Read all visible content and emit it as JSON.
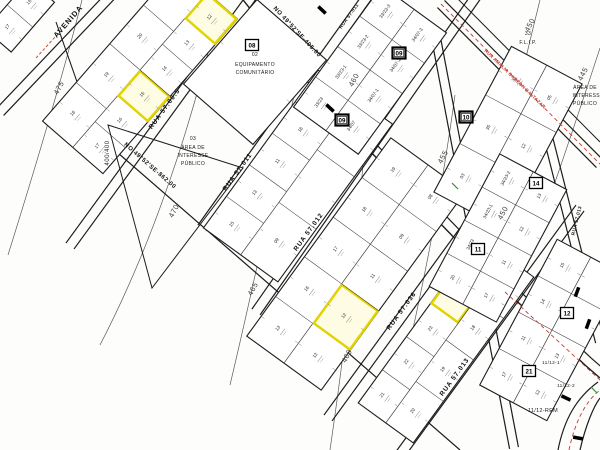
{
  "colors": {
    "background": "#fdfdfb",
    "line": "#1c1c1c",
    "lot_line": "#3c3c3c",
    "contour": "#5a5a5a",
    "highlight": "#e3d400",
    "highlight_fill": "#fffce4",
    "red": "#c43a2e",
    "green": "#3a8a3a"
  },
  "map": {
    "width": 600,
    "height": 450,
    "kind": "cadastral-subdivision-plan"
  },
  "labels": [
    {
      "t": "AVENIDA",
      "x": 70,
      "y": 23,
      "r": -49,
      "s": 7.5,
      "cls": "street"
    },
    {
      "t": "RUA 57.00.5",
      "x": 166,
      "y": 110,
      "r": -54,
      "s": 6.5,
      "cls": "street"
    },
    {
      "t": "RUA 57.011",
      "x": 239,
      "y": 173,
      "r": -54,
      "s": 6.5,
      "cls": "street"
    },
    {
      "t": "RUA 57.011",
      "x": 350,
      "y": 17,
      "r": -54,
      "s": 4.8,
      "cls": "street-sm"
    },
    {
      "t": "RUA 57.012",
      "x": 310,
      "y": 233,
      "r": -54,
      "s": 6.5,
      "cls": "street"
    },
    {
      "t": "RUA 57.036",
      "x": 403,
      "y": 312,
      "r": -54,
      "s": 6.5,
      "cls": "street"
    },
    {
      "t": "RUA 57.013",
      "x": 456,
      "y": 378,
      "r": -54,
      "s": 6.5,
      "cls": "street"
    },
    {
      "t": "RUA 57.013",
      "x": 578,
      "y": 221,
      "r": -76,
      "s": 4.8,
      "cls": "street-sm"
    },
    {
      "t": "RUA AMALIA GARZON BALTAZAR",
      "x": 514,
      "y": 80,
      "r": 44,
      "s": 4.6,
      "cls": "red"
    },
    {
      "t": "NO 49°52'SE-405.00",
      "x": 296,
      "y": 33,
      "r": 47,
      "s": 6,
      "cls": "bearing"
    },
    {
      "t": "NO 49°52'SE-862.00",
      "x": 149,
      "y": 167,
      "r": 41,
      "s": 6,
      "cls": "bearing"
    },
    {
      "t": "400/400",
      "x": 109,
      "y": 153,
      "r": -90,
      "s": 6,
      "cls": "coord"
    },
    {
      "t": "475",
      "x": 61,
      "y": 89,
      "r": -62,
      "s": 7.5,
      "cls": "contour"
    },
    {
      "t": "470",
      "x": 176,
      "y": 212,
      "r": -62,
      "s": 7.5,
      "cls": "contour"
    },
    {
      "t": "465",
      "x": 255,
      "y": 290,
      "r": -62,
      "s": 7.5,
      "cls": "contour"
    },
    {
      "t": "460",
      "x": 356,
      "y": 81,
      "r": -62,
      "s": 7.5,
      "cls": "contour"
    },
    {
      "t": "460",
      "x": 349,
      "y": 357,
      "r": -62,
      "s": 7.5,
      "cls": "contour"
    },
    {
      "t": "455",
      "x": 445,
      "y": 158,
      "r": -62,
      "s": 7.5,
      "cls": "contour"
    },
    {
      "t": "450",
      "x": 532,
      "y": 26,
      "r": -62,
      "s": 7.5,
      "cls": "contour"
    },
    {
      "t": "450",
      "x": 505,
      "y": 214,
      "r": -62,
      "s": 7.5,
      "cls": "contour"
    },
    {
      "t": "445",
      "x": 585,
      "y": 75,
      "r": -62,
      "s": 7.5,
      "cls": "contour"
    },
    {
      "t": "02",
      "x": 255,
      "y": 56,
      "r": 0,
      "s": 5,
      "cls": "area"
    },
    {
      "t": "EQUIPAMENTO",
      "x": 255,
      "y": 66,
      "r": 0,
      "s": 5,
      "cls": "area"
    },
    {
      "t": "COMUNITÁRIO",
      "x": 255,
      "y": 74,
      "r": 0,
      "s": 5,
      "cls": "area"
    },
    {
      "t": "03",
      "x": 193,
      "y": 140,
      "r": 0,
      "s": 5,
      "cls": "area"
    },
    {
      "t": "ÁREA DE",
      "x": 193,
      "y": 149,
      "r": 0,
      "s": 5,
      "cls": "area"
    },
    {
      "t": "INTERESSE",
      "x": 193,
      "y": 157,
      "r": 0,
      "s": 5,
      "cls": "area"
    },
    {
      "t": "PÚBLICO",
      "x": 193,
      "y": 165,
      "r": 0,
      "s": 5,
      "cls": "area"
    },
    {
      "t": "33",
      "x": 528,
      "y": 35,
      "r": 0,
      "s": 5,
      "cls": "area"
    },
    {
      "t": "F.L.I.P.",
      "x": 528,
      "y": 44,
      "r": 0,
      "s": 5,
      "cls": "area"
    },
    {
      "t": "ÁREA DE",
      "x": 585,
      "y": 89,
      "r": 0,
      "s": 5,
      "cls": "area"
    },
    {
      "t": "INTERESSE",
      "x": 588,
      "y": 97,
      "r": 0,
      "s": 5,
      "cls": "area"
    },
    {
      "t": "PÚBLICO",
      "x": 585,
      "y": 105,
      "r": 0,
      "s": 5,
      "cls": "area"
    },
    {
      "t": "11/12-1",
      "x": 551,
      "y": 364,
      "r": 0,
      "s": 4.8,
      "cls": "area"
    },
    {
      "t": "11/12-2",
      "x": 566,
      "y": 387,
      "r": 0,
      "s": 4.8,
      "cls": "area"
    },
    {
      "t": "11/12-REM",
      "x": 543,
      "y": 412,
      "r": 0,
      "s": 5.5,
      "cls": "area"
    }
  ],
  "block_markers": [
    {
      "n": "08",
      "x": 252,
      "y": 45,
      "heavy": false
    },
    {
      "n": "09",
      "x": 399,
      "y": 53,
      "heavy": true
    },
    {
      "n": "09",
      "x": 342,
      "y": 120,
      "heavy": true
    },
    {
      "n": "10",
      "x": 466,
      "y": 117,
      "heavy": true
    },
    {
      "n": "14",
      "x": 536,
      "y": 183,
      "heavy": false
    },
    {
      "n": "11",
      "x": 478,
      "y": 249,
      "heavy": false
    },
    {
      "n": "12",
      "x": 567,
      "y": 313,
      "heavy": false
    },
    {
      "n": "21",
      "x": 529,
      "y": 371,
      "heavy": false
    }
  ],
  "blocks": [
    {
      "cx": 20,
      "cy": 16,
      "rot": -49,
      "len": 66,
      "rows": [
        {
          "h": 34,
          "lots": [
            "17",
            "18"
          ]
        }
      ],
      "hl": []
    },
    {
      "cx": 140,
      "cy": 70,
      "rot": -49,
      "len": 205,
      "rows": [
        {
          "h": 40,
          "lots": [
            "18",
            "19",
            "20",
            ""
          ]
        },
        {
          "h": 40,
          "lots": [
            "17",
            "16",
            "15",
            "14",
            "13",
            "12"
          ]
        }
      ],
      "hl": [
        [
          1,
          2
        ],
        [
          1,
          5
        ]
      ]
    },
    {
      "cx": 255,
      "cy": 72,
      "rot": -49,
      "len": 112,
      "rows": [
        {
          "h": 92,
          "lots": [
            ""
          ]
        }
      ],
      "hl": []
    },
    {
      "cx": 298,
      "cy": 176,
      "rot": -54,
      "len": 195,
      "rows": [
        {
          "h": 46,
          "lots": [
            "15",
            "13",
            "11",
            "16",
            "10"
          ]
        },
        {
          "h": 46,
          "lots": [
            "09",
            "",
            "09"
          ]
        }
      ],
      "hl": []
    },
    {
      "cx": 370,
      "cy": 70,
      "rot": -54,
      "len": 150,
      "rows": [
        {
          "h": 40,
          "lots": [
            "33/23",
            "33/23-1",
            "33/23-2",
            "33/23-3"
          ]
        },
        {
          "h": 40,
          "lots": [
            "34/07",
            "34/07-1",
            "34/07-2",
            "34/07-3"
          ]
        }
      ],
      "hl": []
    },
    {
      "cx": 356,
      "cy": 264,
      "rot": -54,
      "len": 245,
      "rows": [
        {
          "h": 46,
          "lots": [
            "13",
            "16",
            "17",
            "18",
            "19"
          ]
        },
        {
          "h": 46,
          "lots": [
            "13",
            "12",
            "11",
            "09",
            "08"
          ]
        }
      ],
      "hl": [
        [
          1,
          1
        ]
      ]
    },
    {
      "cx": 446,
      "cy": 340,
      "rot": -54,
      "len": 205,
      "rows": [
        {
          "h": 34,
          "lots": [
            "21",
            "22",
            "23",
            "24",
            "25"
          ]
        },
        {
          "h": 34,
          "lots": [
            "20",
            "19",
            "18",
            "17"
          ]
        }
      ],
      "hl": [
        [
          0,
          3
        ]
      ]
    },
    {
      "cx": 508,
      "cy": 138,
      "rot": -62,
      "len": 165,
      "rows": [
        {
          "h": 40,
          "lots": [
            "03",
            "35",
            "31"
          ]
        },
        {
          "h": 40,
          "lots": [
            "13",
            "12",
            "05"
          ]
        }
      ],
      "hl": []
    },
    {
      "cx": 498,
      "cy": 238,
      "rot": -62,
      "len": 150,
      "rows": [
        {
          "h": 38,
          "lots": [
            "20",
            "34/23",
            "34/23-1",
            "34/23-2"
          ]
        },
        {
          "h": 38,
          "lots": [
            "17",
            "11",
            "12",
            "13"
          ]
        }
      ],
      "hl": []
    },
    {
      "cx": 552,
      "cy": 330,
      "rot": -62,
      "len": 165,
      "rows": [
        {
          "h": 38,
          "lots": [
            "17",
            "11",
            "14",
            "15"
          ]
        },
        {
          "h": 38,
          "lots": [
            "12",
            "13",
            "",
            ""
          ]
        }
      ],
      "hl": []
    }
  ]
}
